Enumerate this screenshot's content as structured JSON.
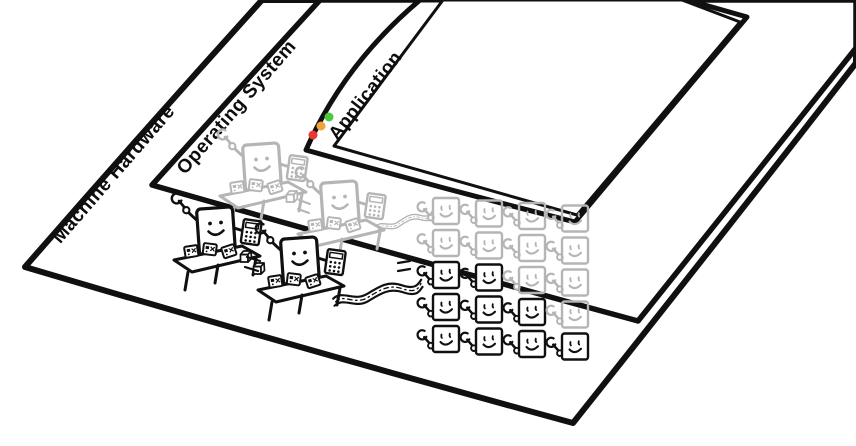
{
  "layers": [
    {
      "id": "machine-hardware",
      "label": "Machine Hardware"
    },
    {
      "id": "operating-system",
      "label": "Operating System"
    },
    {
      "id": "application",
      "label": "Application"
    }
  ],
  "window_controls": [
    {
      "name": "close",
      "color": "#e8392f"
    },
    {
      "name": "minimize",
      "color": "#f0a33c"
    },
    {
      "name": "maximize",
      "color": "#4cc840"
    }
  ],
  "inks": {
    "black": "#101010",
    "gray": "#b5b5b5"
  },
  "worker_grid": {
    "rows": 5,
    "cols": 4,
    "cells": [
      [
        "g",
        "g",
        "g",
        "g"
      ],
      [
        "g",
        "g",
        "g",
        "g"
      ],
      [
        "b",
        "b",
        "g",
        "g"
      ],
      [
        "b",
        "b",
        "b",
        "g"
      ],
      [
        "b",
        "b",
        "b",
        "b"
      ]
    ],
    "legend": {
      "g": "faded os-layer worker",
      "b": "black hardware-layer worker"
    }
  },
  "scene": {
    "hardware_desk_workers": 2,
    "os_desk_workers": 2,
    "conveyor_roads": 2,
    "icons": [
      "wrench-icon",
      "calculator-icon",
      "package-icon",
      "smiley-face-icon",
      "cube-box-icon",
      "conveyor-road",
      "traffic-light-close-icon",
      "traffic-light-minimize-icon",
      "traffic-light-maximize-icon"
    ]
  }
}
